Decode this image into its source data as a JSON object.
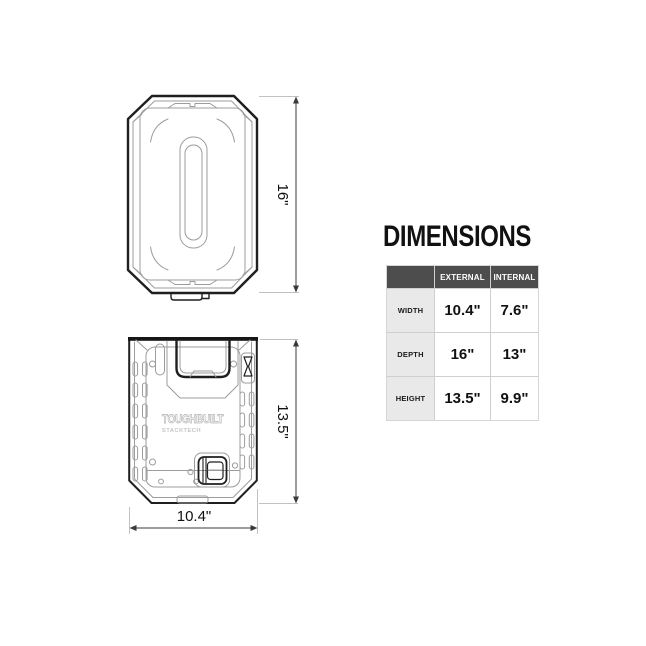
{
  "panel": {
    "title": "DIMENSIONS",
    "table": {
      "columns": [
        "",
        "EXTERNAL",
        "INTERNAL"
      ],
      "rows": [
        {
          "label": "WIDTH",
          "external": "10.4\"",
          "internal": "7.6\""
        },
        {
          "label": "DEPTH",
          "external": "16\"",
          "internal": "13\""
        },
        {
          "label": "HEIGHT",
          "external": "13.5\"",
          "internal": "9.9\""
        }
      ]
    }
  },
  "drawings": {
    "top_view": {
      "depth_label": "16\""
    },
    "front_view": {
      "height_label": "13.5\"",
      "width_label": "10.4\"",
      "logo": "TOUGHBUILT",
      "logo_sub": "STACKTECH"
    }
  },
  "colors": {
    "table_header_bg": "#4d4d4d",
    "table_label_bg": "#e9e9e9",
    "table_border": "#cfcfcf",
    "outline_black": "#1f1f1f",
    "detail_gray": "#9c9c9c",
    "extension_gray": "#c2c2c2",
    "text": "#111111"
  }
}
